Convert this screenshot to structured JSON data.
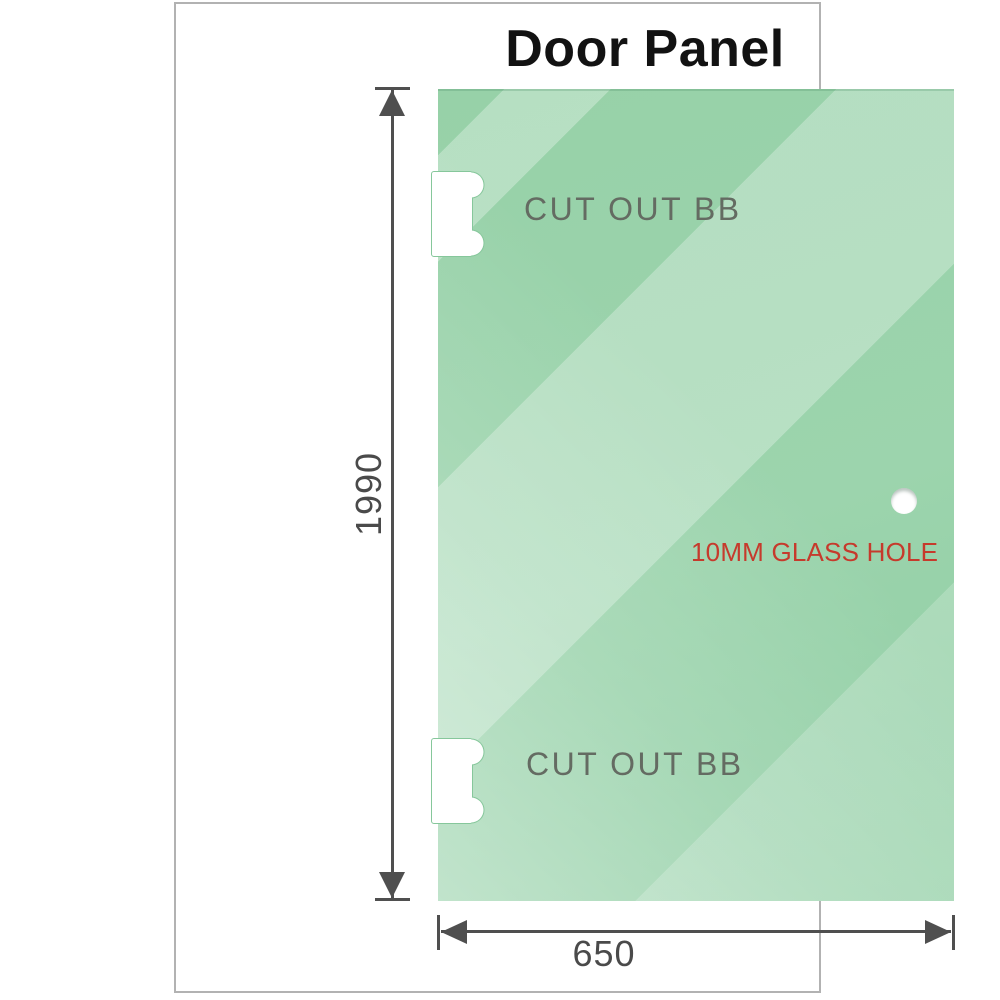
{
  "title": "Door Panel",
  "panel": {
    "cutout_top_label": "CUT OUT BB",
    "cutout_bottom_label": "CUT OUT BB",
    "hole_label": "10MM GLASS HOLE"
  },
  "dimensions": {
    "height_value": "1990",
    "width_value": "650"
  },
  "colors": {
    "glass_base": "#97d1a8",
    "glass_highlight": "#cdebd6",
    "cutout_outline": "#86c79b",
    "outline_gray": "#4f4f4f",
    "dim_text": "#4a4a4a",
    "cutout_text": "#646b62",
    "hole_label_red": "#c63a2c",
    "frame_border": "#b2b2b2",
    "title_color": "#121212"
  }
}
